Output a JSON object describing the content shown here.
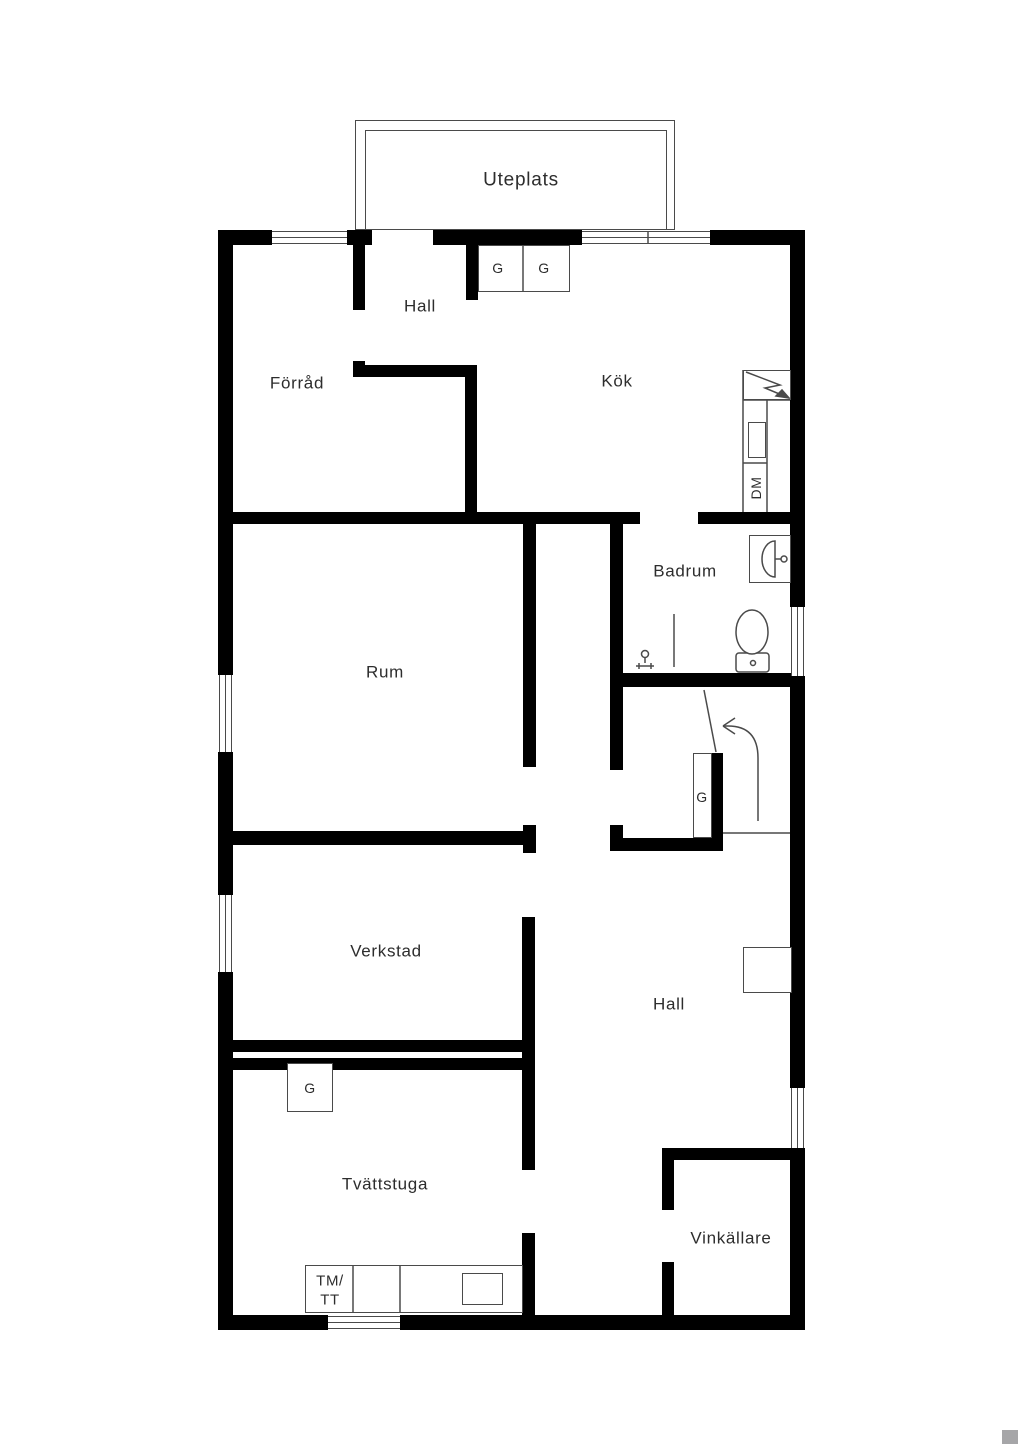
{
  "colors": {
    "background": "#ffffff",
    "wall": "#000000",
    "line": "#4a4a4a",
    "text": "#2d2d2d",
    "watermark": "#a6a6a8"
  },
  "labels": [
    {
      "id": "uteplats",
      "text": "Uteplats",
      "x": 521,
      "y": 180,
      "size": 19
    },
    {
      "id": "hall-upper",
      "text": "Hall",
      "x": 420,
      "y": 306,
      "size": 17
    },
    {
      "id": "forrad",
      "text": "Förråd",
      "x": 297,
      "y": 383,
      "size": 17
    },
    {
      "id": "kok",
      "text": "Kök",
      "x": 617,
      "y": 381,
      "size": 17
    },
    {
      "id": "g-kitchen-1",
      "text": "G",
      "x": 498,
      "y": 268,
      "size": 14
    },
    {
      "id": "g-kitchen-2",
      "text": "G",
      "x": 544,
      "y": 268,
      "size": 14
    },
    {
      "id": "dm",
      "text": "DM",
      "x": 756,
      "y": 488,
      "size": 14,
      "rot": -90
    },
    {
      "id": "badrum",
      "text": "Badrum",
      "x": 685,
      "y": 571,
      "size": 17
    },
    {
      "id": "rum",
      "text": "Rum",
      "x": 385,
      "y": 672,
      "size": 17
    },
    {
      "id": "g-stairs",
      "text": "G",
      "x": 702,
      "y": 797,
      "size": 14
    },
    {
      "id": "verkstad",
      "text": "Verkstad",
      "x": 386,
      "y": 951,
      "size": 17
    },
    {
      "id": "hall-lower",
      "text": "Hall",
      "x": 669,
      "y": 1004,
      "size": 17
    },
    {
      "id": "g-laundry",
      "text": "G",
      "x": 310,
      "y": 1088,
      "size": 14
    },
    {
      "id": "tvattstuga",
      "text": "Tvättstuga",
      "x": 385,
      "y": 1184,
      "size": 17
    },
    {
      "id": "tm-line1",
      "text": "TM/",
      "x": 330,
      "y": 1281,
      "size": 15
    },
    {
      "id": "tm-line2",
      "text": "TT",
      "x": 330,
      "y": 1300,
      "size": 15
    },
    {
      "id": "vinkallare",
      "text": "Vinkällare",
      "x": 731,
      "y": 1238,
      "size": 17
    }
  ],
  "walls": [
    {
      "name": "top-wall-1",
      "x": 218,
      "y": 230,
      "w": 54,
      "h": 15
    },
    {
      "name": "top-wall-2",
      "x": 347,
      "y": 230,
      "w": 25,
      "h": 15
    },
    {
      "name": "top-wall-3",
      "x": 433,
      "y": 230,
      "w": 149,
      "h": 15
    },
    {
      "name": "top-wall-4",
      "x": 710,
      "y": 230,
      "w": 95,
      "h": 15
    },
    {
      "name": "left-wall-1",
      "x": 218,
      "y": 230,
      "w": 15,
      "h": 445
    },
    {
      "name": "left-wall-2",
      "x": 218,
      "y": 752,
      "w": 15,
      "h": 143
    },
    {
      "name": "left-wall-3",
      "x": 218,
      "y": 972,
      "w": 15,
      "h": 358
    },
    {
      "name": "right-wall-1",
      "x": 790,
      "y": 230,
      "w": 15,
      "h": 377
    },
    {
      "name": "right-wall-2",
      "x": 790,
      "y": 676,
      "w": 15,
      "h": 412
    },
    {
      "name": "right-wall-3",
      "x": 790,
      "y": 1148,
      "w": 15,
      "h": 182
    },
    {
      "name": "bottom-wall-1",
      "x": 218,
      "y": 1315,
      "w": 110,
      "h": 15
    },
    {
      "name": "bottom-wall-2",
      "x": 400,
      "y": 1315,
      "w": 405,
      "h": 15
    },
    {
      "name": "hall-stub-wall",
      "x": 353,
      "y": 245,
      "w": 12,
      "h": 65
    },
    {
      "name": "kok-stub-wall",
      "x": 466,
      "y": 245,
      "w": 12,
      "h": 55
    },
    {
      "name": "forrad-wall-cap",
      "x": 353,
      "y": 361,
      "w": 12,
      "h": 16
    },
    {
      "name": "forrad-wall-h",
      "x": 353,
      "y": 365,
      "w": 124,
      "h": 12
    },
    {
      "name": "forrad-kok-wall",
      "x": 465,
      "y": 365,
      "w": 12,
      "h": 152
    },
    {
      "name": "mid-wall-left",
      "x": 218,
      "y": 512,
      "w": 422,
      "h": 12
    },
    {
      "name": "mid-wall-right",
      "x": 698,
      "y": 512,
      "w": 92,
      "h": 12
    },
    {
      "name": "rum-right-wall",
      "x": 523,
      "y": 512,
      "w": 13,
      "h": 255
    },
    {
      "name": "badrum-left-wall",
      "x": 610,
      "y": 512,
      "w": 13,
      "h": 258
    },
    {
      "name": "badrum-bottom-wall",
      "x": 610,
      "y": 673,
      "w": 182,
      "h": 14
    },
    {
      "name": "stair-left-corner",
      "x": 610,
      "y": 825,
      "w": 13,
      "h": 25
    },
    {
      "name": "stair-bottom-wall",
      "x": 610,
      "y": 838,
      "w": 113,
      "h": 13
    },
    {
      "name": "stair-g-wall",
      "x": 712,
      "y": 753,
      "w": 11,
      "h": 97
    },
    {
      "name": "rum-bottom-wall",
      "x": 233,
      "y": 831,
      "w": 290,
      "h": 14
    },
    {
      "name": "rum-bottom-stub",
      "x": 523,
      "y": 825,
      "w": 13,
      "h": 28
    },
    {
      "name": "verkstad-right-wall",
      "x": 522,
      "y": 917,
      "w": 13,
      "h": 253
    },
    {
      "name": "verkstad-bottom-wall",
      "x": 232,
      "y": 1040,
      "w": 290,
      "h": 12
    },
    {
      "name": "tvattstuga-top-wall",
      "x": 232,
      "y": 1058,
      "w": 290,
      "h": 12
    },
    {
      "name": "hall-tvatt-wall",
      "x": 522,
      "y": 1233,
      "w": 13,
      "h": 84
    },
    {
      "name": "vinkallare-top-wall",
      "x": 662,
      "y": 1148,
      "w": 128,
      "h": 12
    },
    {
      "name": "vinkallare-left-wall-1",
      "x": 662,
      "y": 1148,
      "w": 12,
      "h": 62
    },
    {
      "name": "vinkallare-left-wall-2",
      "x": 662,
      "y": 1262,
      "w": 12,
      "h": 55
    }
  ],
  "windows": [
    {
      "name": "window-entry",
      "x": 272,
      "y": 231,
      "w": 75,
      "h": 13,
      "dir": "h"
    },
    {
      "name": "window-kitchen",
      "x": 582,
      "y": 231,
      "w": 128,
      "h": 13,
      "dir": "h"
    },
    {
      "name": "window-rum",
      "x": 219,
      "y": 675,
      "w": 13,
      "h": 77,
      "dir": "v"
    },
    {
      "name": "window-verkstad",
      "x": 219,
      "y": 895,
      "w": 13,
      "h": 77,
      "dir": "v"
    },
    {
      "name": "window-badrum",
      "x": 791,
      "y": 607,
      "w": 13,
      "h": 69,
      "dir": "v"
    },
    {
      "name": "window-hall",
      "x": 791,
      "y": 1088,
      "w": 13,
      "h": 60,
      "dir": "v"
    },
    {
      "name": "window-tvattstuga",
      "x": 328,
      "y": 1316,
      "w": 72,
      "h": 13,
      "dir": "h"
    }
  ],
  "furniture_rects": [
    {
      "name": "uteplats-outer-edge",
      "x": 355,
      "y": 120,
      "w": 320,
      "h": 110
    },
    {
      "name": "uteplats-inner-edge",
      "x": 365,
      "y": 130,
      "w": 302,
      "h": 100,
      "open": true
    },
    {
      "name": "kitchen-wardrobes-box",
      "x": 478,
      "y": 245,
      "w": 92,
      "h": 47
    },
    {
      "name": "stove-box",
      "x": 743,
      "y": 370,
      "w": 48,
      "h": 30
    },
    {
      "name": "counter-sink-box",
      "x": 748,
      "y": 422,
      "w": 18,
      "h": 36
    },
    {
      "name": "bath-sink-box",
      "x": 749,
      "y": 535,
      "w": 42,
      "h": 48
    },
    {
      "name": "hall-shelf-box",
      "x": 743,
      "y": 947,
      "w": 49,
      "h": 46
    },
    {
      "name": "stair-wardrobe-box",
      "x": 693,
      "y": 753,
      "w": 19,
      "h": 85
    },
    {
      "name": "laundry-wardrobe-box",
      "x": 287,
      "y": 1063,
      "w": 46,
      "h": 49
    },
    {
      "name": "laundry-counter-box",
      "x": 305,
      "y": 1265,
      "w": 218,
      "h": 48
    },
    {
      "name": "laundry-sink-box",
      "x": 462,
      "y": 1273,
      "w": 41,
      "h": 32
    }
  ],
  "svg_lines": [
    {
      "name": "counter-left-line",
      "x1": 743,
      "y1": 370,
      "x2": 743,
      "y2": 512
    },
    {
      "name": "counter-mid-line",
      "x1": 767,
      "y1": 400,
      "x2": 767,
      "y2": 512
    },
    {
      "name": "counter-top-line",
      "x1": 743,
      "y1": 400,
      "x2": 790,
      "y2": 400
    },
    {
      "name": "counter-divider-line",
      "x1": 743,
      "y1": 463,
      "x2": 767,
      "y2": 463
    },
    {
      "name": "kitchen-window-divider",
      "x1": 648,
      "y1": 232,
      "x2": 648,
      "y2": 244
    },
    {
      "name": "wardrobe-divider-line",
      "x1": 523,
      "y1": 246,
      "x2": 523,
      "y2": 291
    },
    {
      "name": "shower-rail-line",
      "x1": 674,
      "y1": 614,
      "x2": 674,
      "y2": 667
    },
    {
      "name": "sink-tap-line",
      "x1": 775,
      "y1": 559,
      "x2": 781,
      "y2": 559
    },
    {
      "name": "stair-cut-line",
      "x1": 704,
      "y1": 690,
      "x2": 716,
      "y2": 752
    },
    {
      "name": "stair-edge-line",
      "x1": 723,
      "y1": 833,
      "x2": 790,
      "y2": 833
    },
    {
      "name": "laundry-divider-1",
      "x1": 353,
      "y1": 1266,
      "x2": 353,
      "y2": 1312
    },
    {
      "name": "laundry-divider-2",
      "x1": 400,
      "y1": 1266,
      "x2": 400,
      "y2": 1312
    }
  ],
  "svg_circles": [
    {
      "name": "sink-tap-circle",
      "cx": 784,
      "cy": 559,
      "r": 3
    },
    {
      "name": "toilet-button-circle",
      "cx": 753,
      "cy": 663,
      "r": 2.5
    },
    {
      "name": "drain-head-circle",
      "cx": 645,
      "cy": 654,
      "r": 3.5
    }
  ],
  "svg_ellipses": [
    {
      "name": "toilet-bowl",
      "cx": 752,
      "cy": 632,
      "rx": 16,
      "ry": 22
    }
  ],
  "svg_paths": [
    {
      "name": "toilet-tank",
      "d": "M739,653 h27 a3,3 0 0 1 3,3 v13 a3,3 0 0 1 -3,3 h-27 a3,3 0 0 1 -3,-3 v-13 a3,3 0 0 1 3,-3 Z",
      "fill": "#fff"
    },
    {
      "name": "bath-sink-basin",
      "d": "M775,541 A13,18 0 0 0 775,577 Z",
      "fill": "#fff"
    },
    {
      "name": "stove-bolt",
      "d": "M746,372 L780,385 L765,388 L789,398",
      "fill": "none"
    },
    {
      "name": "stove-bolt-tip",
      "d": "M789,398 L776,396 L782,390 Z",
      "fill": "#4a4a4a"
    },
    {
      "name": "drain-stand",
      "d": "M645,657 L645,663 M636,666 L654,666 M639,663 L639,669 M651,663 L651,669",
      "fill": "none"
    },
    {
      "name": "stair-arrow",
      "d": "M758,821 L758,758 Q758,726 728,726 L723,726",
      "fill": "none"
    },
    {
      "name": "stair-arrowhead",
      "d": "M723,726 L735,718 M723,726 L735,734",
      "fill": "none"
    }
  ],
  "watermark": {
    "x": 1002,
    "y": 1430,
    "w": 16,
    "h": 14
  }
}
